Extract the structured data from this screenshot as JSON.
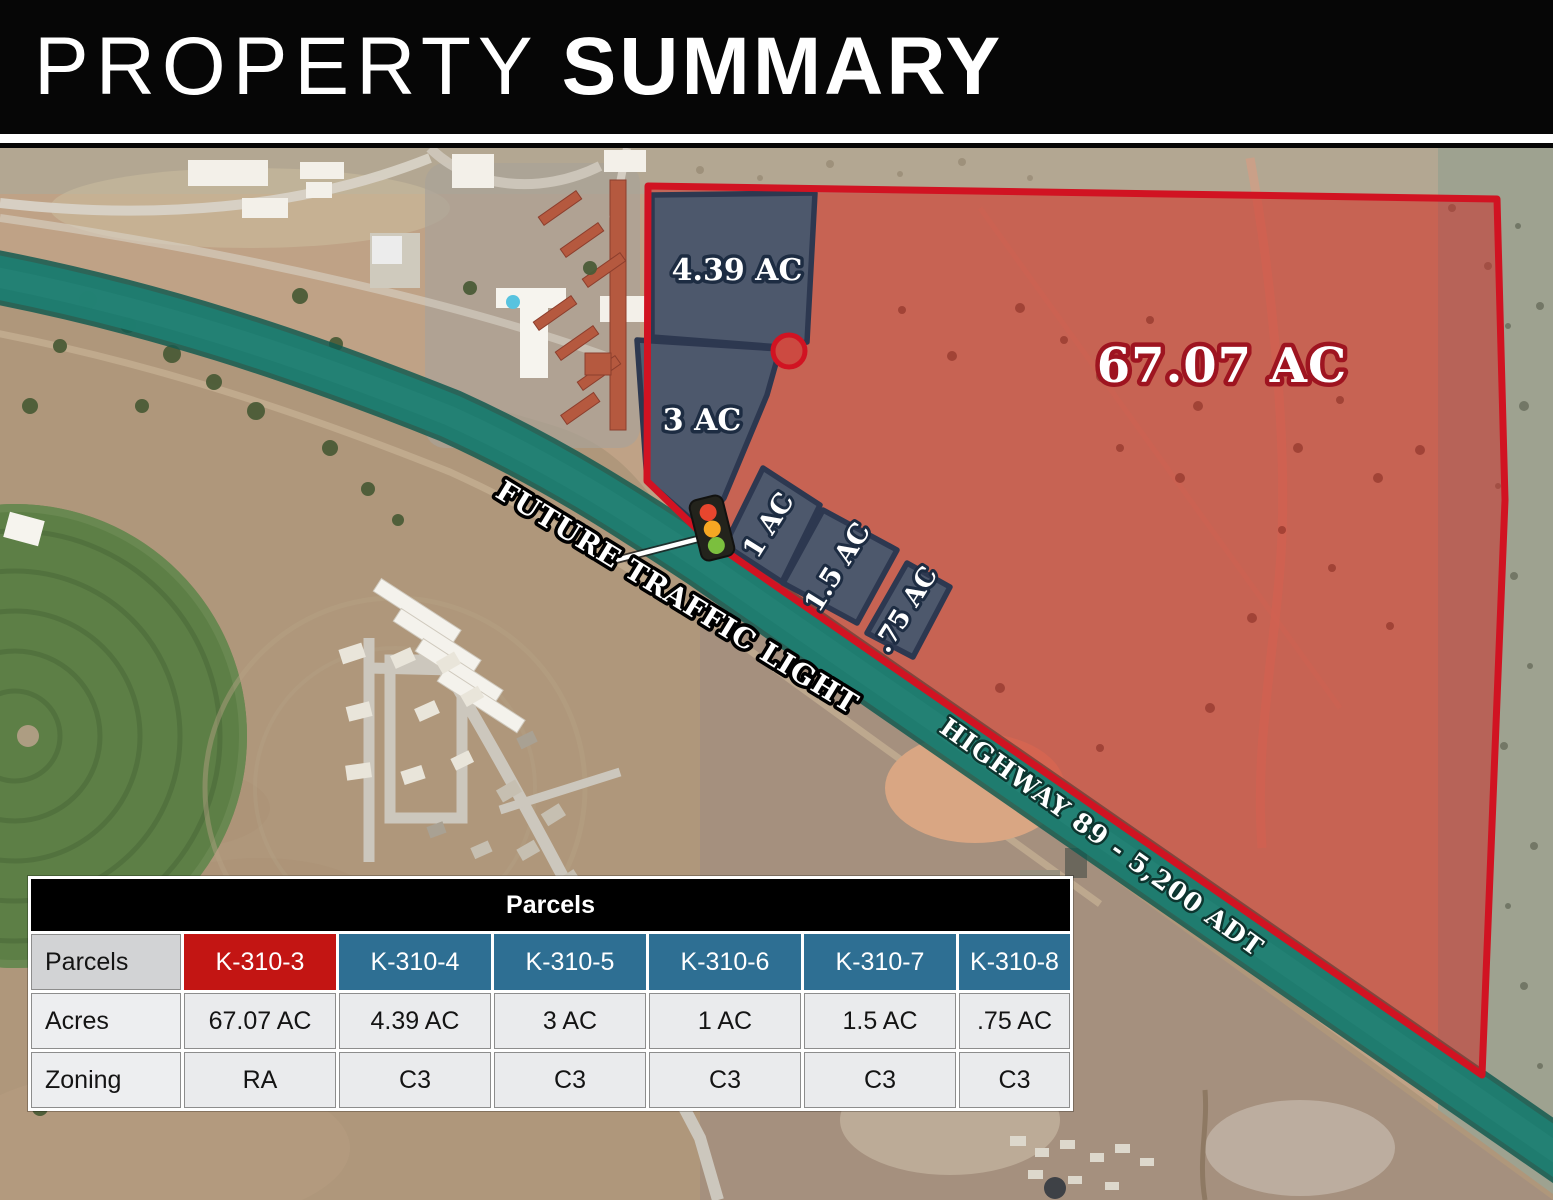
{
  "header": {
    "title_light": "PROPERTY",
    "title_bold": "SUMMARY"
  },
  "map": {
    "labels": {
      "main_parcel_acres": "67.07 AC",
      "parcel_4_39": "4.39 AC",
      "parcel_3": "3 AC",
      "parcel_1": "1 AC",
      "parcel_1_5": "1.5 AC",
      "parcel_0_75": ".75 AC",
      "future_traffic_light": "FUTURE TRAFFIC LIGHT",
      "highway": "HIGHWAY 89 - 5,200 ADT"
    },
    "colors": {
      "boundary_red": "#D11322",
      "parcel_red_fill": "#D02A25",
      "parcel_blue_fill": "#3C5670",
      "highway_teal": "#1F7D70"
    }
  },
  "table": {
    "title": "Parcels",
    "row_labels": [
      "Parcels",
      "Acres",
      "Zoning"
    ],
    "columns": [
      "K-310-3",
      "K-310-4",
      "K-310-5",
      "K-310-6",
      "K-310-7",
      "K-310-8"
    ],
    "acres": [
      "67.07 AC",
      "4.39 AC",
      "3 AC",
      "1 AC",
      "1.5 AC",
      ".75 AC"
    ],
    "zoning": [
      "RA",
      "C3",
      "C3",
      "C3",
      "C3",
      "C3"
    ],
    "colors": {
      "highlight_red": "#C31513",
      "header_blue": "#2E6F93"
    }
  }
}
